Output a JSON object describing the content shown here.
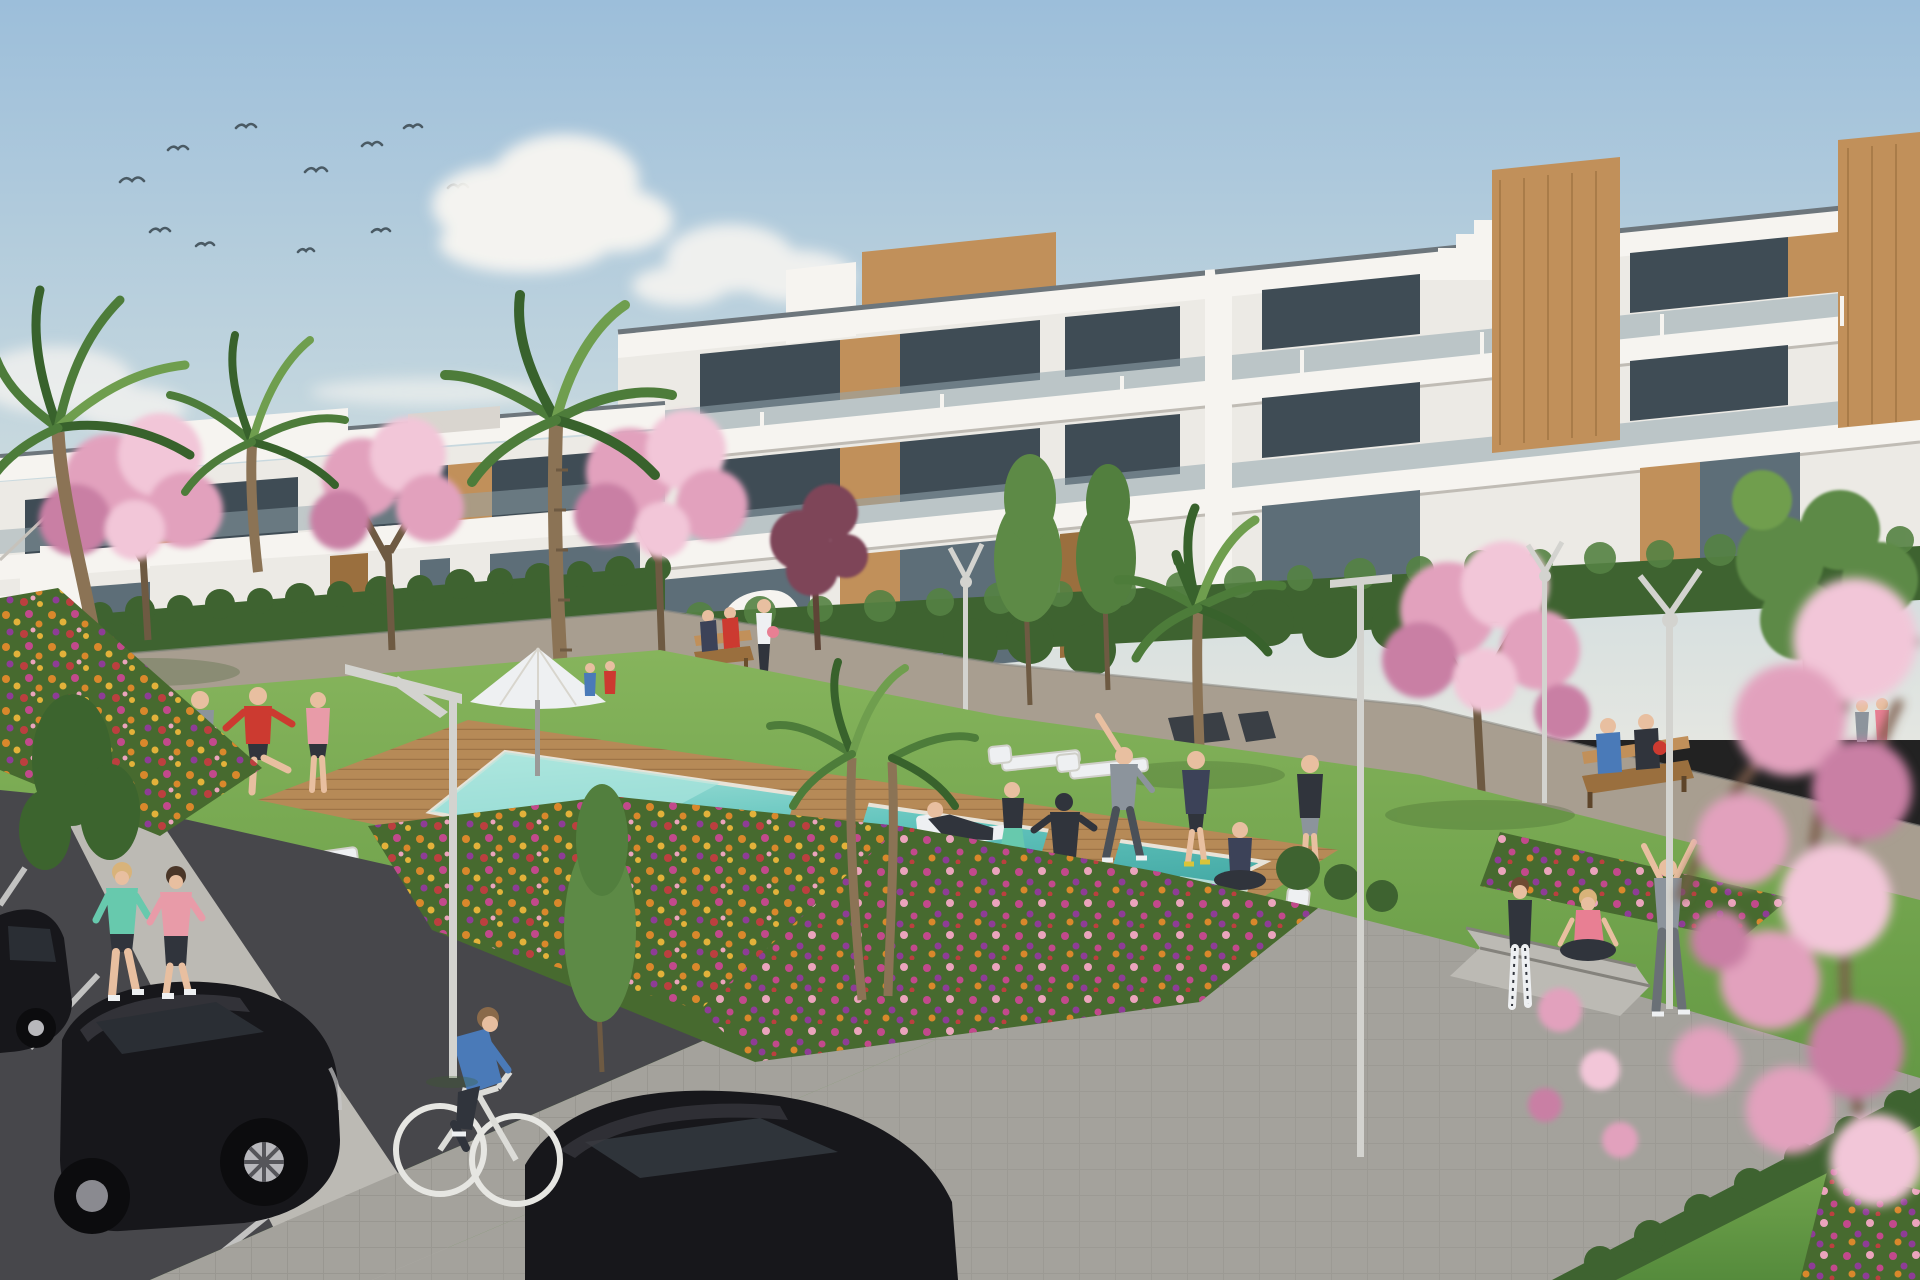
{
  "scene": {
    "type": "architectural-exterior-3d-render",
    "subject": "modern white apartment complex with communal pool garden",
    "time_of_day": "sunny daytime",
    "visible_text": "none"
  },
  "inventory": {
    "birds": 11,
    "cloud_clusters": 5,
    "apartment_buildings": 2,
    "palm_trees": 6,
    "blossom_trees": 5,
    "green_trees": 6,
    "street_lamps": 5,
    "sun_loungers": 8,
    "parasols": 1,
    "benches": 4,
    "people": 26,
    "cars": 3,
    "bicycles": 1,
    "pools": 1,
    "flower_beds": 4
  },
  "colors": {
    "sky_top": "#9cbeda",
    "sky_mid": "#c3d6de",
    "sky_horizon": "#e4e6e1",
    "cloud": "#f7f5f1",
    "bird": "#4a5a64",
    "white_hi": "#f6f4f0",
    "white": "#eceae5",
    "white_shade": "#d9d5cf",
    "white_dark": "#c6c2bb",
    "coping": "#6d767c",
    "glass_dark": "#3f4c55",
    "glass_mid": "#5d6e78",
    "glass_hi": "#93a6ae",
    "wood": "#c1905a",
    "wood_dark": "#9a6f3e",
    "hedge": "#3e6330",
    "hedge_hi": "#558243",
    "lawn_light": "#86b45c",
    "lawn": "#6da04a",
    "lawn_dark": "#4f7d36",
    "palm": "#4d7c3a",
    "palm_dark": "#38622c",
    "palm_hi": "#6f9e4e",
    "trunk": "#8b7355",
    "blossom": "#e2a1bd",
    "blossom_hi": "#f2c6d8",
    "blossom_dk": "#c97fa4",
    "plum": "#7e4458",
    "bed_base": "#476a2f",
    "flower_orange": "#d9882b",
    "flower_magenta": "#c2498c",
    "flower_purple": "#8e3c96",
    "flower_yellow": "#e3b23a",
    "flower_red": "#bc3f3f",
    "flower_lightpink": "#eba4bc",
    "deck": "#b68a57",
    "deck_line": "#8a6138",
    "pool_light": "#aee6de",
    "pool": "#62c4bd",
    "pool_deep": "#3da39f",
    "pool_edge": "#e8e3d8",
    "path": "#a4a29c",
    "path_warm": "#a89e90",
    "path_hi": "#bcbab4",
    "asphalt": "#47474b",
    "parking_line": "#d8d8d6",
    "car_black": "#17171b",
    "car_hi": "#3a3a40",
    "alloy": "#b8b8bc",
    "metal": "#d3d3cf",
    "metal_dark": "#9a9a98",
    "skin": "#e8bfa0",
    "cloth_teal": "#67c9ad",
    "cloth_pink": "#e89ba8",
    "cloth_red": "#cc3a30",
    "cloth_blue": "#4a7ab8",
    "cloth_gray": "#8c949c",
    "cloth_dark": "#30343c",
    "cloth_navy": "#3c4258",
    "cloth_rose": "#e87f93",
    "cloth_white": "#eef0f2"
  }
}
